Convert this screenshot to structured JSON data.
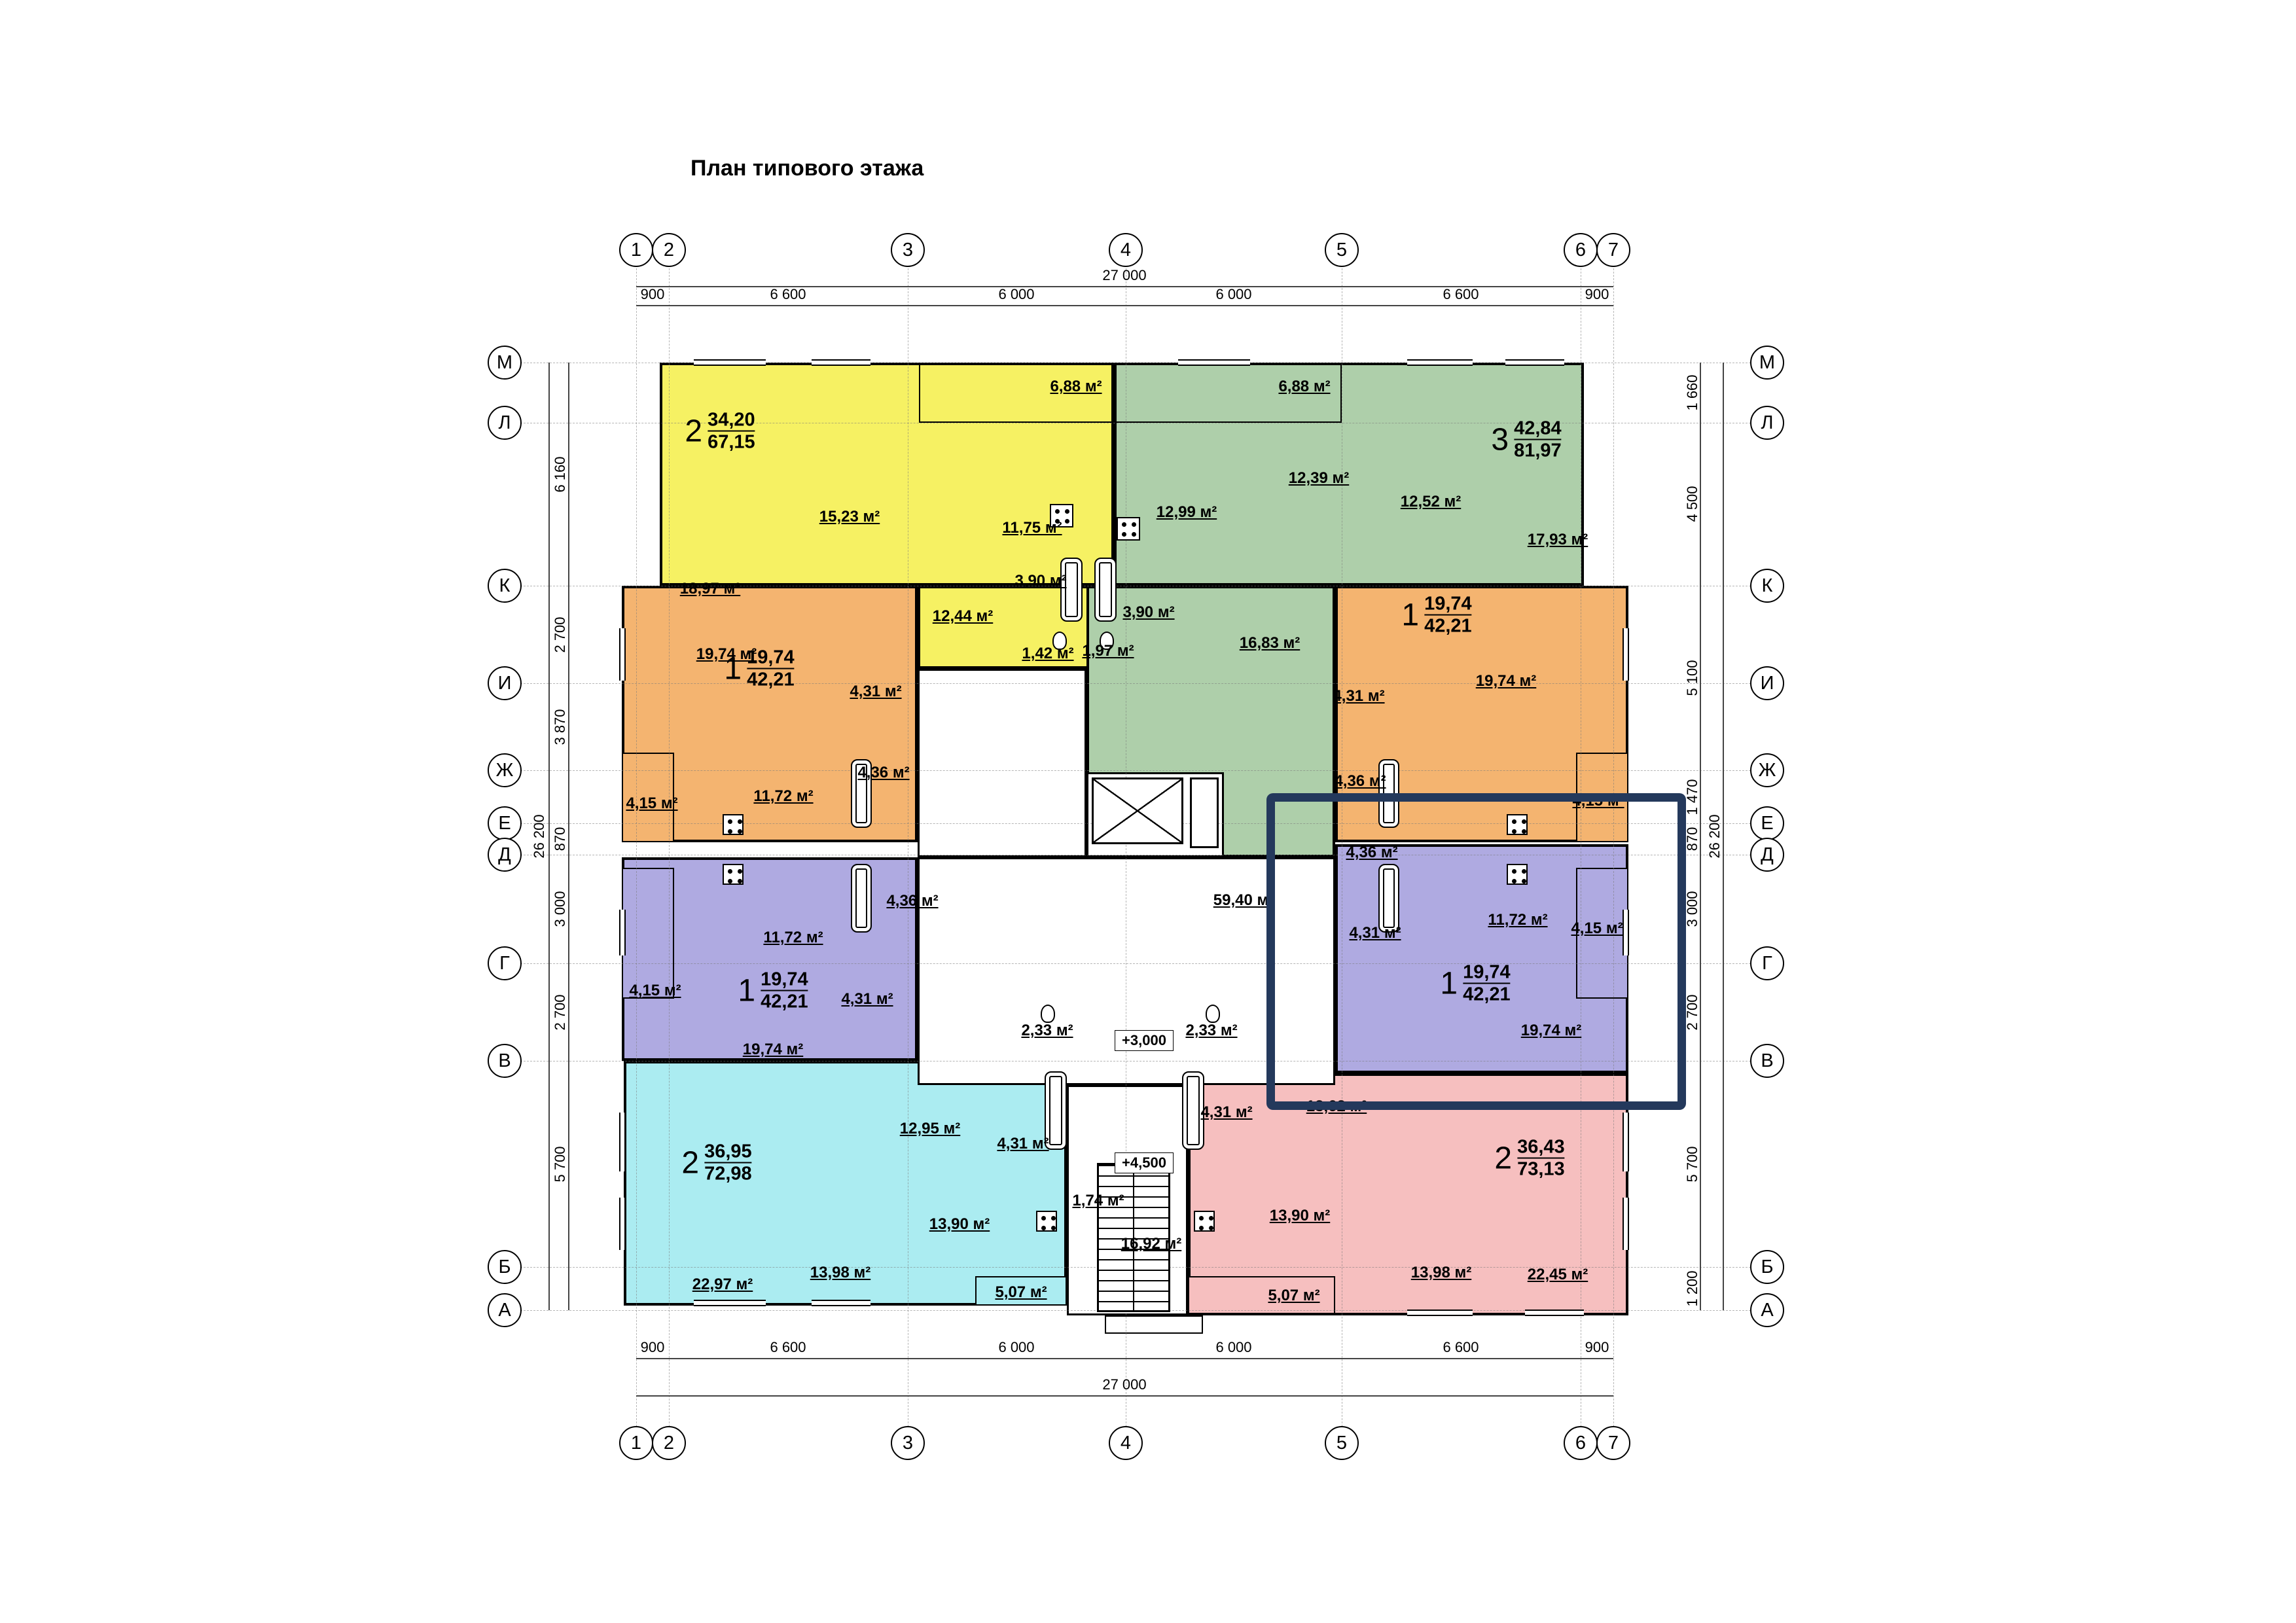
{
  "title": "План типового этажа",
  "axes": {
    "cols": [
      "1",
      "2",
      "3",
      "4",
      "5",
      "6",
      "7"
    ],
    "rows": [
      "М",
      "Л",
      "К",
      "И",
      "Ж",
      "Е",
      "Д",
      "Г",
      "В",
      "Б",
      "А"
    ]
  },
  "dims": {
    "top": [
      "900",
      "6 600",
      "6 000",
      "6 000",
      "6 600",
      "900"
    ],
    "top_total": "27 000",
    "bottom": [
      "900",
      "6 600",
      "6 000",
      "6 000",
      "6 600",
      "900"
    ],
    "bottom_total": "27 000",
    "left": [
      "6 160",
      "2 700",
      "3 870",
      "870",
      "3 000",
      "2 700",
      "5 700"
    ],
    "left_total": "26 200",
    "right": [
      "1 660",
      "4 500",
      "5 100",
      "1 470",
      "870",
      "3 000",
      "2 700",
      "5 700",
      "1 200"
    ],
    "right_total": "26 200"
  },
  "levels": {
    "l1": "+3,000",
    "l2": "+4,500"
  },
  "common": {
    "corridor": "59,40 м²",
    "vestibule": "16,92 м²",
    "closet": "1,74 м²"
  },
  "colors": {
    "yellow": "#f6f163",
    "green": "#aecfaa",
    "orange": "#f4b470",
    "purple": "#afaae1",
    "cyan": "#abecf1",
    "pink": "#f6bfbf",
    "highlight": "#24395c",
    "walls": "#000000"
  },
  "apartments": {
    "yellow": {
      "type": "2",
      "a1": "34,20",
      "a2": "67,15",
      "rooms": {
        "r1": "18,97 м²",
        "r2": "15,23 м²",
        "r3": "11,75 м²",
        "r4": "3,90 м²",
        "r5": "1,42 м²",
        "r6": "12,44 м²",
        "balcony": "6,88 м²"
      }
    },
    "green": {
      "type": "3",
      "a1": "42,84",
      "a2": "81,97",
      "rooms": {
        "r1": "12,99 м²",
        "r2": "12,39 м²",
        "r3": "12,52 м²",
        "r4": "17,93 м²",
        "r5": "16,83 м²",
        "r6": "3,90 м²",
        "r7": "1,97 м²",
        "balcony": "6,88 м²"
      }
    },
    "orange_left": {
      "type": "1",
      "a1": "19,74",
      "a2": "42,21",
      "rooms": {
        "r1": "19,74 м²",
        "r2": "4,31 м²",
        "r3": "4,36 м²",
        "r4": "11,72 м²",
        "balcony": "4,15 м²"
      }
    },
    "orange_right": {
      "type": "1",
      "a1": "19,74",
      "a2": "42,21",
      "rooms": {
        "r1": "19,74 м²",
        "r2": "4,31 м²",
        "r3": "4,36 м²",
        "balcony": "4,15 м²"
      }
    },
    "purple_left": {
      "type": "1",
      "a1": "19,74",
      "a2": "42,21",
      "rooms": {
        "r1": "19,74 м²",
        "r2": "11,72 м²",
        "r3": "4,36 м²",
        "r4": "4,31 м²",
        "balcony": "4,15 м²"
      }
    },
    "purple_right": {
      "type": "1",
      "a1": "19,74",
      "a2": "42,21",
      "rooms": {
        "r1": "19,74 м²",
        "r2": "11,72 м²",
        "r3": "4,36 м²",
        "r4": "4,31 м²",
        "balcony": "4,15 м²"
      }
    },
    "cyan": {
      "type": "2",
      "a1": "36,95",
      "a2": "72,98",
      "rooms": {
        "r1": "22,97 м²",
        "r2": "13,98 м²",
        "r3": "12,95 м²",
        "r4": "4,31 м²",
        "r5": "13,90 м²",
        "r6": "2,33 м²",
        "balcony": "5,07 м²"
      }
    },
    "pink": {
      "type": "2",
      "a1": "36,43",
      "a2": "73,13",
      "rooms": {
        "r1": "22,45 м²",
        "r2": "13,98 м²",
        "r3": "13,90 м²",
        "r4": "13,62 м²",
        "r5": "4,31 м²",
        "r6": "2,33 м²",
        "balcony": "5,07 м²"
      }
    }
  }
}
